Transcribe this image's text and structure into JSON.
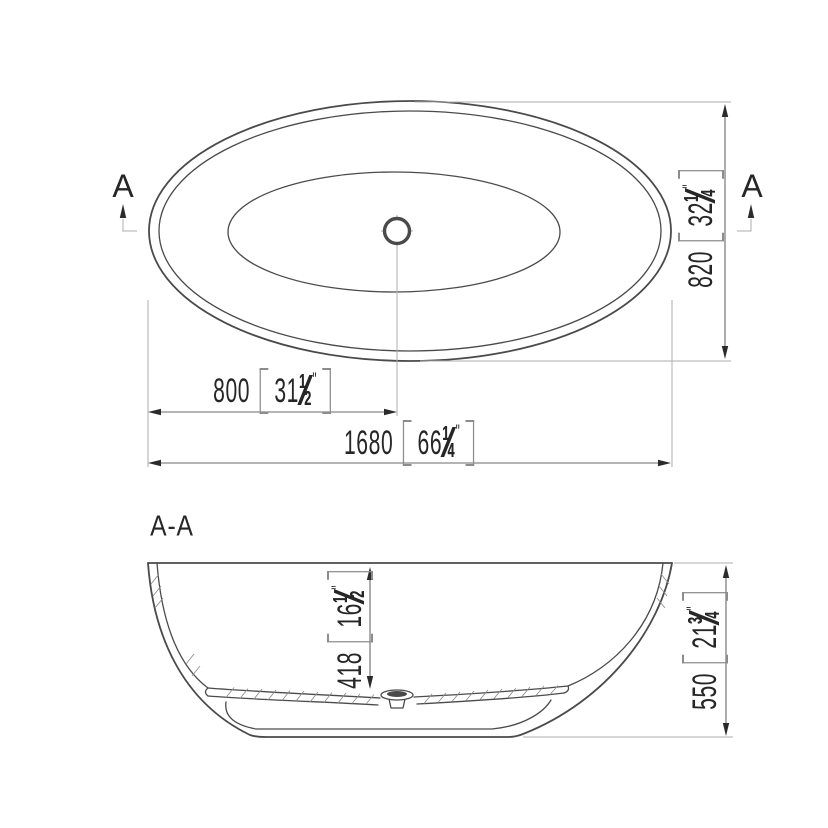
{
  "labels": {
    "section_cut": "A",
    "section_view": "A-A"
  },
  "glyphs": {
    "fraction_slash": "⁄"
  },
  "dimensions": {
    "overall_width": {
      "mm": "820",
      "inch_whole": "32",
      "frac_num": "1",
      "frac_den": "4",
      "unit_mark": "\""
    },
    "drain_from_left": {
      "mm": "800",
      "inch_whole": "31",
      "frac_num": "1",
      "frac_den": "2",
      "unit_mark": "\""
    },
    "overall_length": {
      "mm": "1680",
      "inch_whole": "66",
      "frac_num": "1",
      "frac_den": "4",
      "unit_mark": "\""
    },
    "inner_depth": {
      "mm": "418",
      "inch_whole": "16",
      "frac_num": "1",
      "frac_den": "2",
      "unit_mark": "\""
    },
    "overall_height": {
      "mm": "550",
      "inch_whole": "21",
      "frac_num": "3",
      "frac_den": "4",
      "unit_mark": "\""
    }
  },
  "colors": {
    "line": "#4a4a4a",
    "dim_line": "#6a6a6a",
    "light_line": "#adadad",
    "arrow": "#2b2b2b",
    "hatch": "#8f8f8f",
    "text": "#262626",
    "bracket": "#8c8c8c",
    "background": "#ffffff"
  }
}
